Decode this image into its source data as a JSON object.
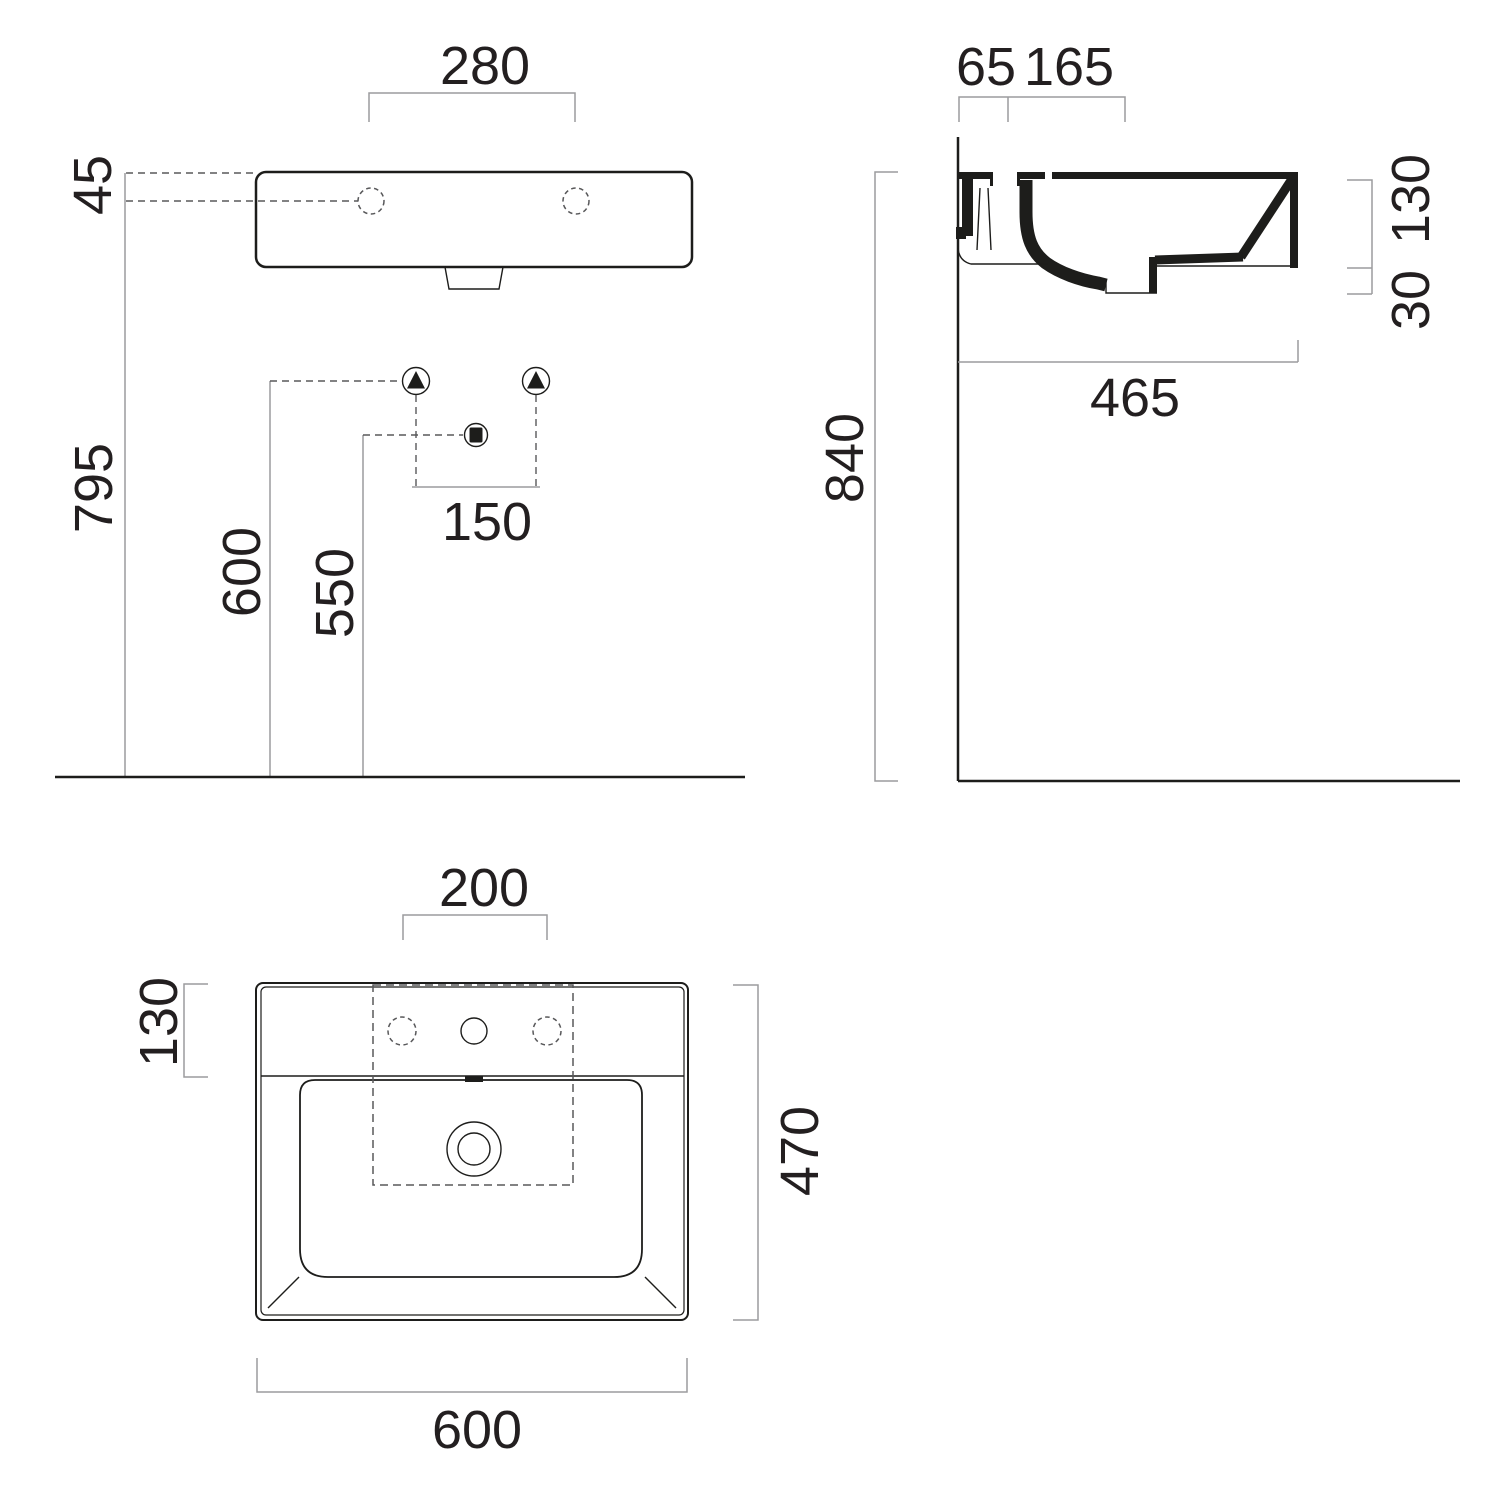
{
  "title": "Wall-hung washbasin technical dimension drawing",
  "units": "mm",
  "colors": {
    "outline": "#1d1d1b",
    "dimension_line": "#9c9c9e",
    "dashed_line": "#58585a",
    "text": "#231f20",
    "background": "#ffffff"
  },
  "front_view": {
    "name": "front elevation",
    "dims": {
      "faucet_spacing": "280",
      "rim_to_hole": "45",
      "floor_to_hole": "795",
      "floor_to_supply": "600",
      "floor_to_drain": "550",
      "supply_spacing": "150"
    },
    "symbols": {
      "supply": "triangle-in-circle",
      "waste": "square-in-circle"
    }
  },
  "side_view": {
    "name": "side section",
    "dims": {
      "wall_to_hole": "65",
      "hole_to_overflow": "165",
      "basin_height": "130",
      "drain_depth": "30",
      "basin_depth": "465",
      "floor_to_rim": "840"
    }
  },
  "plan_view": {
    "name": "top plan",
    "dims": {
      "hole_spacing": "200",
      "rim_to_bowl": "130",
      "basin_depth": "470",
      "basin_width": "600"
    }
  }
}
